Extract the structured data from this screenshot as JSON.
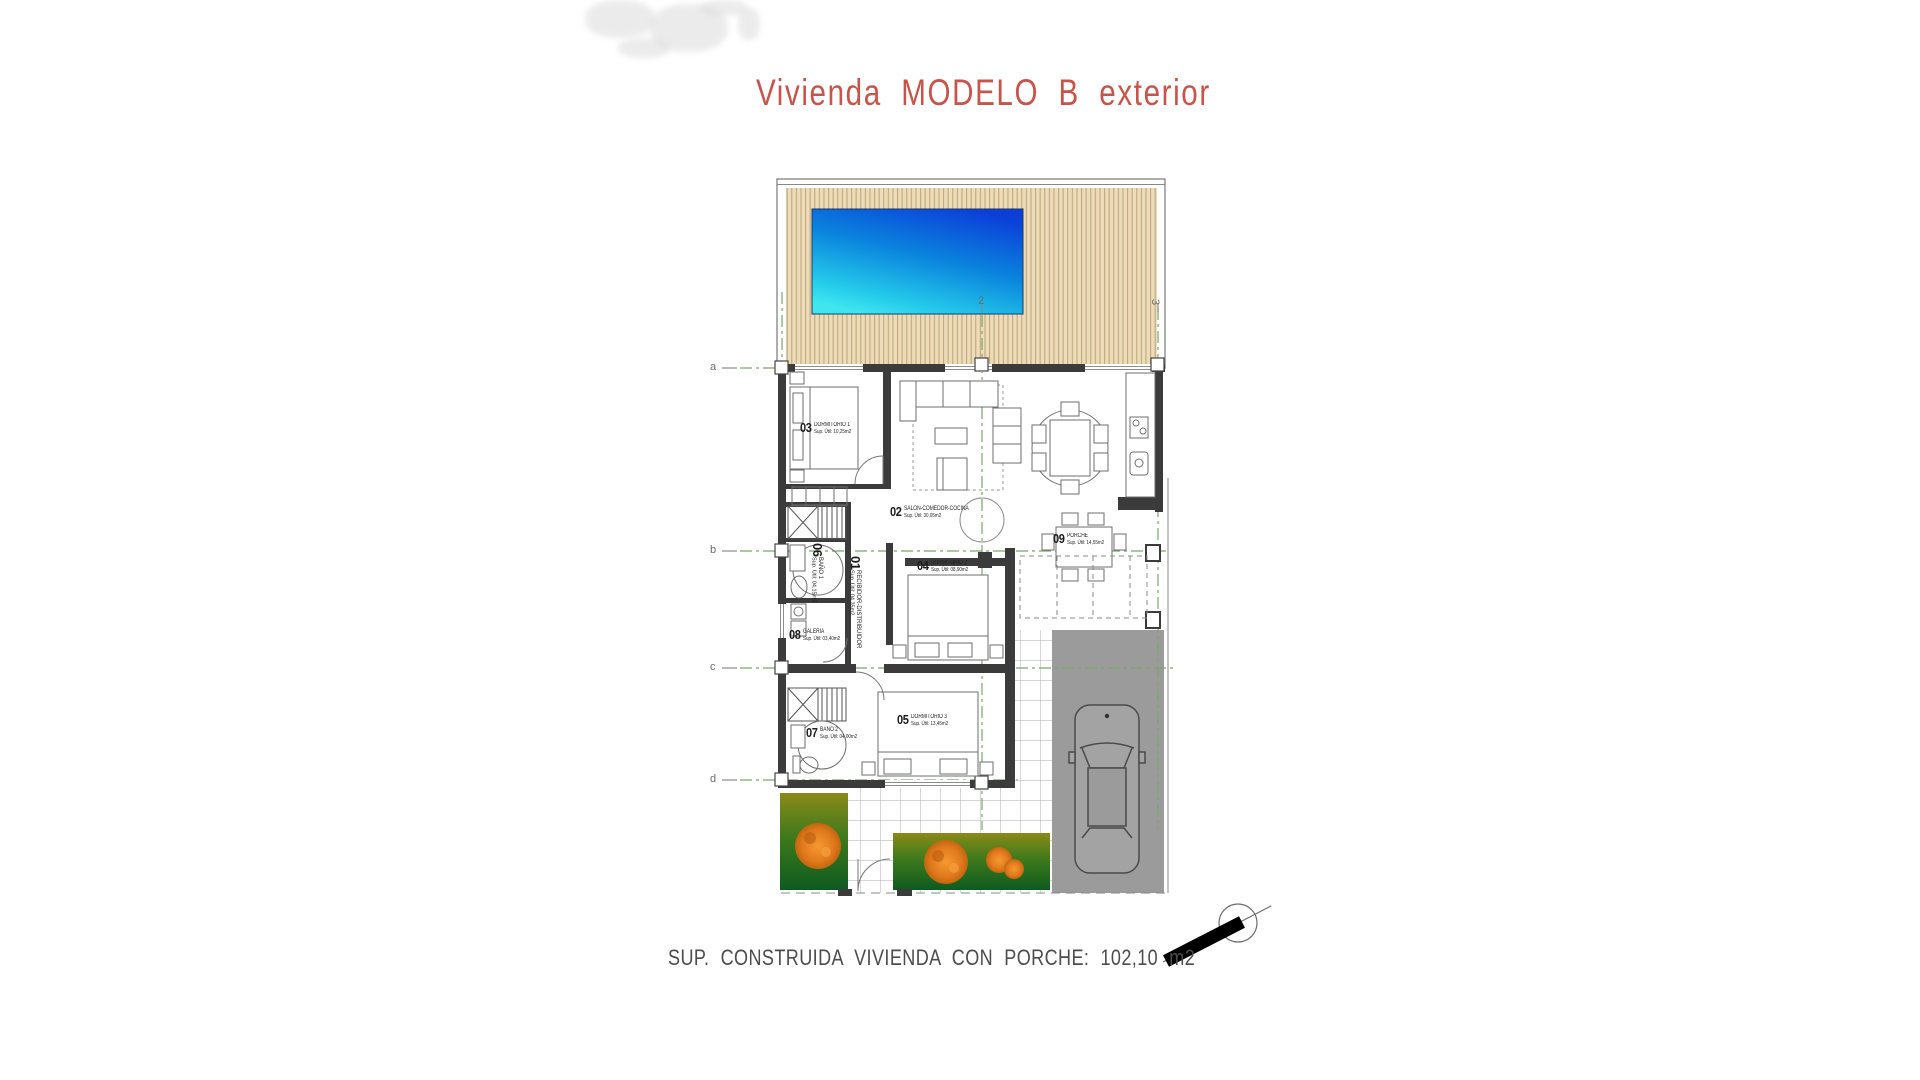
{
  "title": {
    "text": "Vivienda MODELO B exterior",
    "color": "#c7544a"
  },
  "footer": {
    "text": "SUP. CONSTRUIDA VIVIENDA CON PORCHE: 102,10 m2"
  },
  "grid": {
    "rows": [
      "a",
      "b",
      "c",
      "d"
    ],
    "cols": [
      "2",
      "3"
    ]
  },
  "rooms": [
    {
      "number": "01",
      "name": "RECIBIDOR-DISTRIBUIDOR",
      "area": "Sup. Útil: 04,35m2"
    },
    {
      "number": "02",
      "name": "SALÓN-COMEDOR-COCINA",
      "area": "Sup. Útil: 30,05m2"
    },
    {
      "number": "03",
      "name": "DORMITORIO 1",
      "area": "Sup. Útil: 10,25m2"
    },
    {
      "number": "04",
      "name": "DORMITORIO 2",
      "area": "Sup. Útil: 08,90m2"
    },
    {
      "number": "05",
      "name": "DORMITORIO 3",
      "area": "Sup. Útil: 13,45m2"
    },
    {
      "number": "06",
      "name": "BAÑO 1",
      "area": "Sup. Útil: 04,15m2"
    },
    {
      "number": "07",
      "name": "BAÑO 2",
      "area": "Sup. Útil: 04,00m2"
    },
    {
      "number": "08",
      "name": "GALERÍA",
      "area": "Sup. Útil: 03,40m2"
    },
    {
      "number": "09",
      "name": "PORCHE",
      "area": "Sup. Útil: 14,55m2"
    }
  ],
  "colors": {
    "title_red": "#c7544a",
    "pool_deep": "#0b3fd8",
    "pool_shallow": "#3fe6ee",
    "deck_tan": "#ecdcba",
    "deck_stripe": "#c2a87a",
    "gridline_green": "#7aa76b",
    "wall_dark": "#3b3b3b",
    "driveway_gray": "#9b9b9b",
    "garden_olive": "#8a8a1a",
    "garden_green": "#0d5a20",
    "tree_orange": "#e0781c"
  },
  "icons": {
    "compass": "north-arrow"
  }
}
